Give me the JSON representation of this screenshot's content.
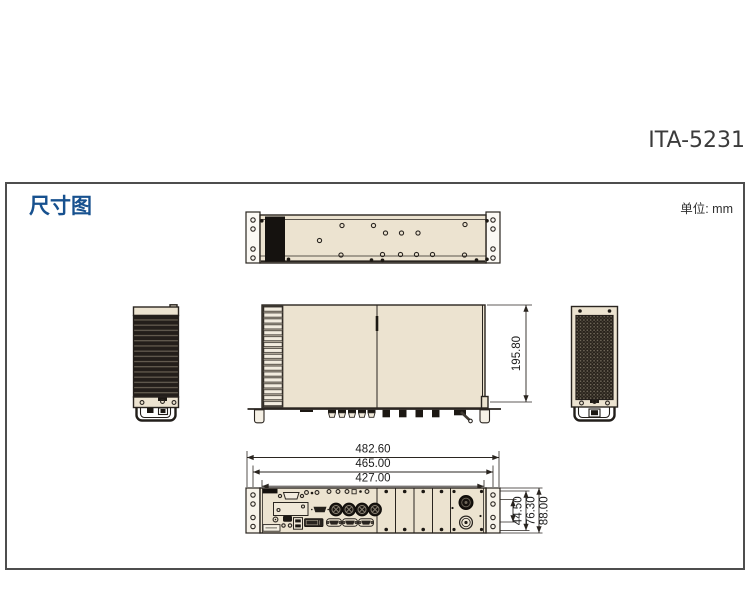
{
  "page": {
    "product_model": "ITA-5231"
  },
  "section": {
    "title": "尺寸图",
    "unit_label": "单位: mm"
  },
  "dimension_labels": {
    "chassis_depth": "195.80",
    "front_width_overall": "482.60",
    "front_width_mount_holes": "465.00",
    "front_width_body": "427.00",
    "front_height_inner": "44.50",
    "front_height_mid": "76.30",
    "front_height_overall": "88.00"
  },
  "colors": {
    "accent_blue": "#17518f",
    "chassis_fill": "#ece3d0",
    "line_dark": "#2a2520",
    "frame_border": "#4e4e4e",
    "title_gray": "#3b3b3b"
  }
}
